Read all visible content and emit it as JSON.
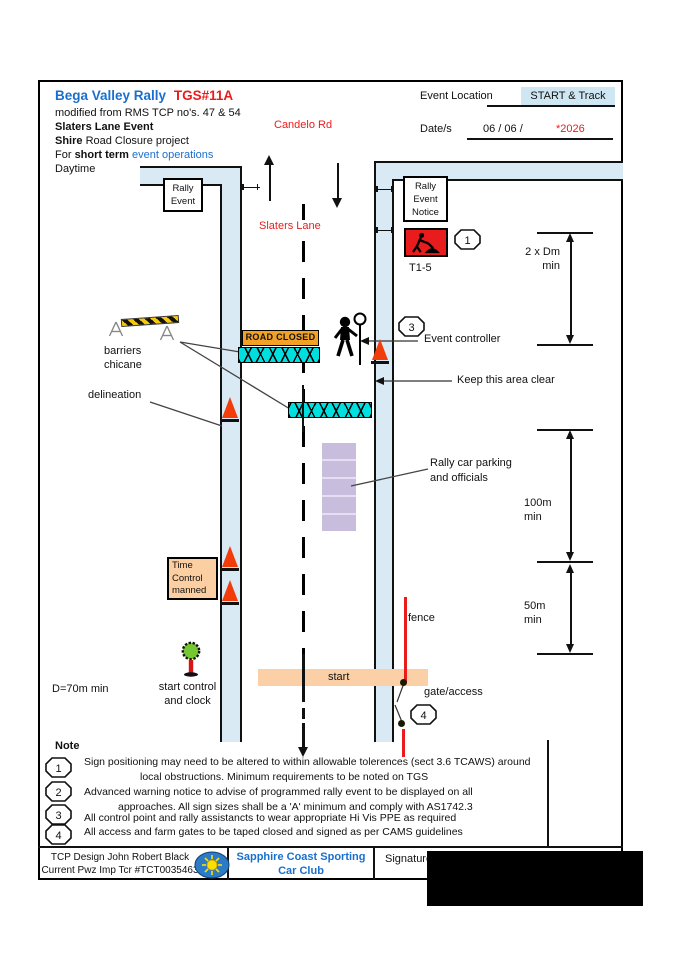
{
  "title": {
    "club_event": "Bega Valley Rally",
    "tgs": "TGS#11A"
  },
  "header": {
    "modified": "modified from RMS TCP no's. 47 & 54",
    "event_name": "Slaters Lane Event",
    "shire_bold": "Shire",
    "shire_rest": " Road Closure project",
    "for_pre": "For ",
    "for_bold": "short term",
    "for_link": " event operations",
    "daytime": "Daytime",
    "event_location_label": "Event Location",
    "event_location_value": "START & Track",
    "date_label": "Date/s",
    "date_value": "06  /  06 /",
    "date_year": "*2026"
  },
  "roads": {
    "top_road": "Candelo Rd",
    "main_road": "Slaters Lane"
  },
  "signs": {
    "rally_event_l1": "Rally",
    "rally_event_l2": "Event",
    "notice_l1": "Rally",
    "notice_l2": "Event",
    "notice_l3": "Notice",
    "t15": "T1-5",
    "road_closed": "ROAD CLOSED",
    "time_control_l1": "Time",
    "time_control_l2": "Control",
    "time_control_l3": "manned",
    "start": "start"
  },
  "callouts": {
    "t15": "1",
    "controller": "3",
    "gate": "4"
  },
  "labels": {
    "barriers_l1": "barriers",
    "barriers_l2": "chicane",
    "delineation": "delineation",
    "event_controller": "Event controller",
    "keep_clear": "Keep this area clear",
    "parking_l1": "Rally car parking",
    "parking_l2": "and officials",
    "fence": "fence",
    "gate": "gate/access",
    "start_control_l1": "start control",
    "start_control_l2": "and clock",
    "d70": "D=70m min"
  },
  "dimensions": {
    "dm": {
      "l1": "2 x Dm",
      "l2": "min"
    },
    "m100": {
      "l1": "100m",
      "l2": "min"
    },
    "m50": {
      "l1": "50m",
      "l2": "min"
    }
  },
  "notes": {
    "heading": "Note",
    "items": [
      {
        "num": "1",
        "line1": "Sign positioning may need to be altered to within allowable tolerences (sect 3.6 TCAWS) around",
        "line2": "local obstructions. Minimum requirements to be noted on TGS"
      },
      {
        "num": "2",
        "line1": "Advanced warning notice to advise of programmed rally event to be displayed on all",
        "line2": "approaches. All sign sizes shall be a 'A' minimum and comply with AS1742.3"
      },
      {
        "num": "3",
        "line1": "All control point and rally assistancts to wear appropriate Hi Vis PPE as  required",
        "line2": ""
      },
      {
        "num": "4",
        "line1": "All access and farm gates to be taped closed and signed as per CAMS guidelines",
        "line2": ""
      }
    ]
  },
  "footer": {
    "design_l1": "TCP Design John Robert Black",
    "design_l2": "Current Pwz Imp Tcr  #TCT0035463",
    "club_l1": "Sapphire Coast Sporting",
    "club_l2": "Car Club",
    "signature": "Signature"
  },
  "colors": {
    "accent_blue": "#1a6fce",
    "accent_red": "#ec1c1c",
    "road_fill": "#daeaf4",
    "barrier_cyan": "#00dfe0",
    "sign_orange": "#f2a124",
    "peach": "#fbcfa2",
    "parking_purple": "#c9bddd",
    "cone_red": "#f23c0a",
    "fence_red": "#e81c1c",
    "highlight_blue": "#cfe7f2",
    "logo_blue": "#2b7bc7",
    "logo_yellow": "#ffdf00"
  }
}
